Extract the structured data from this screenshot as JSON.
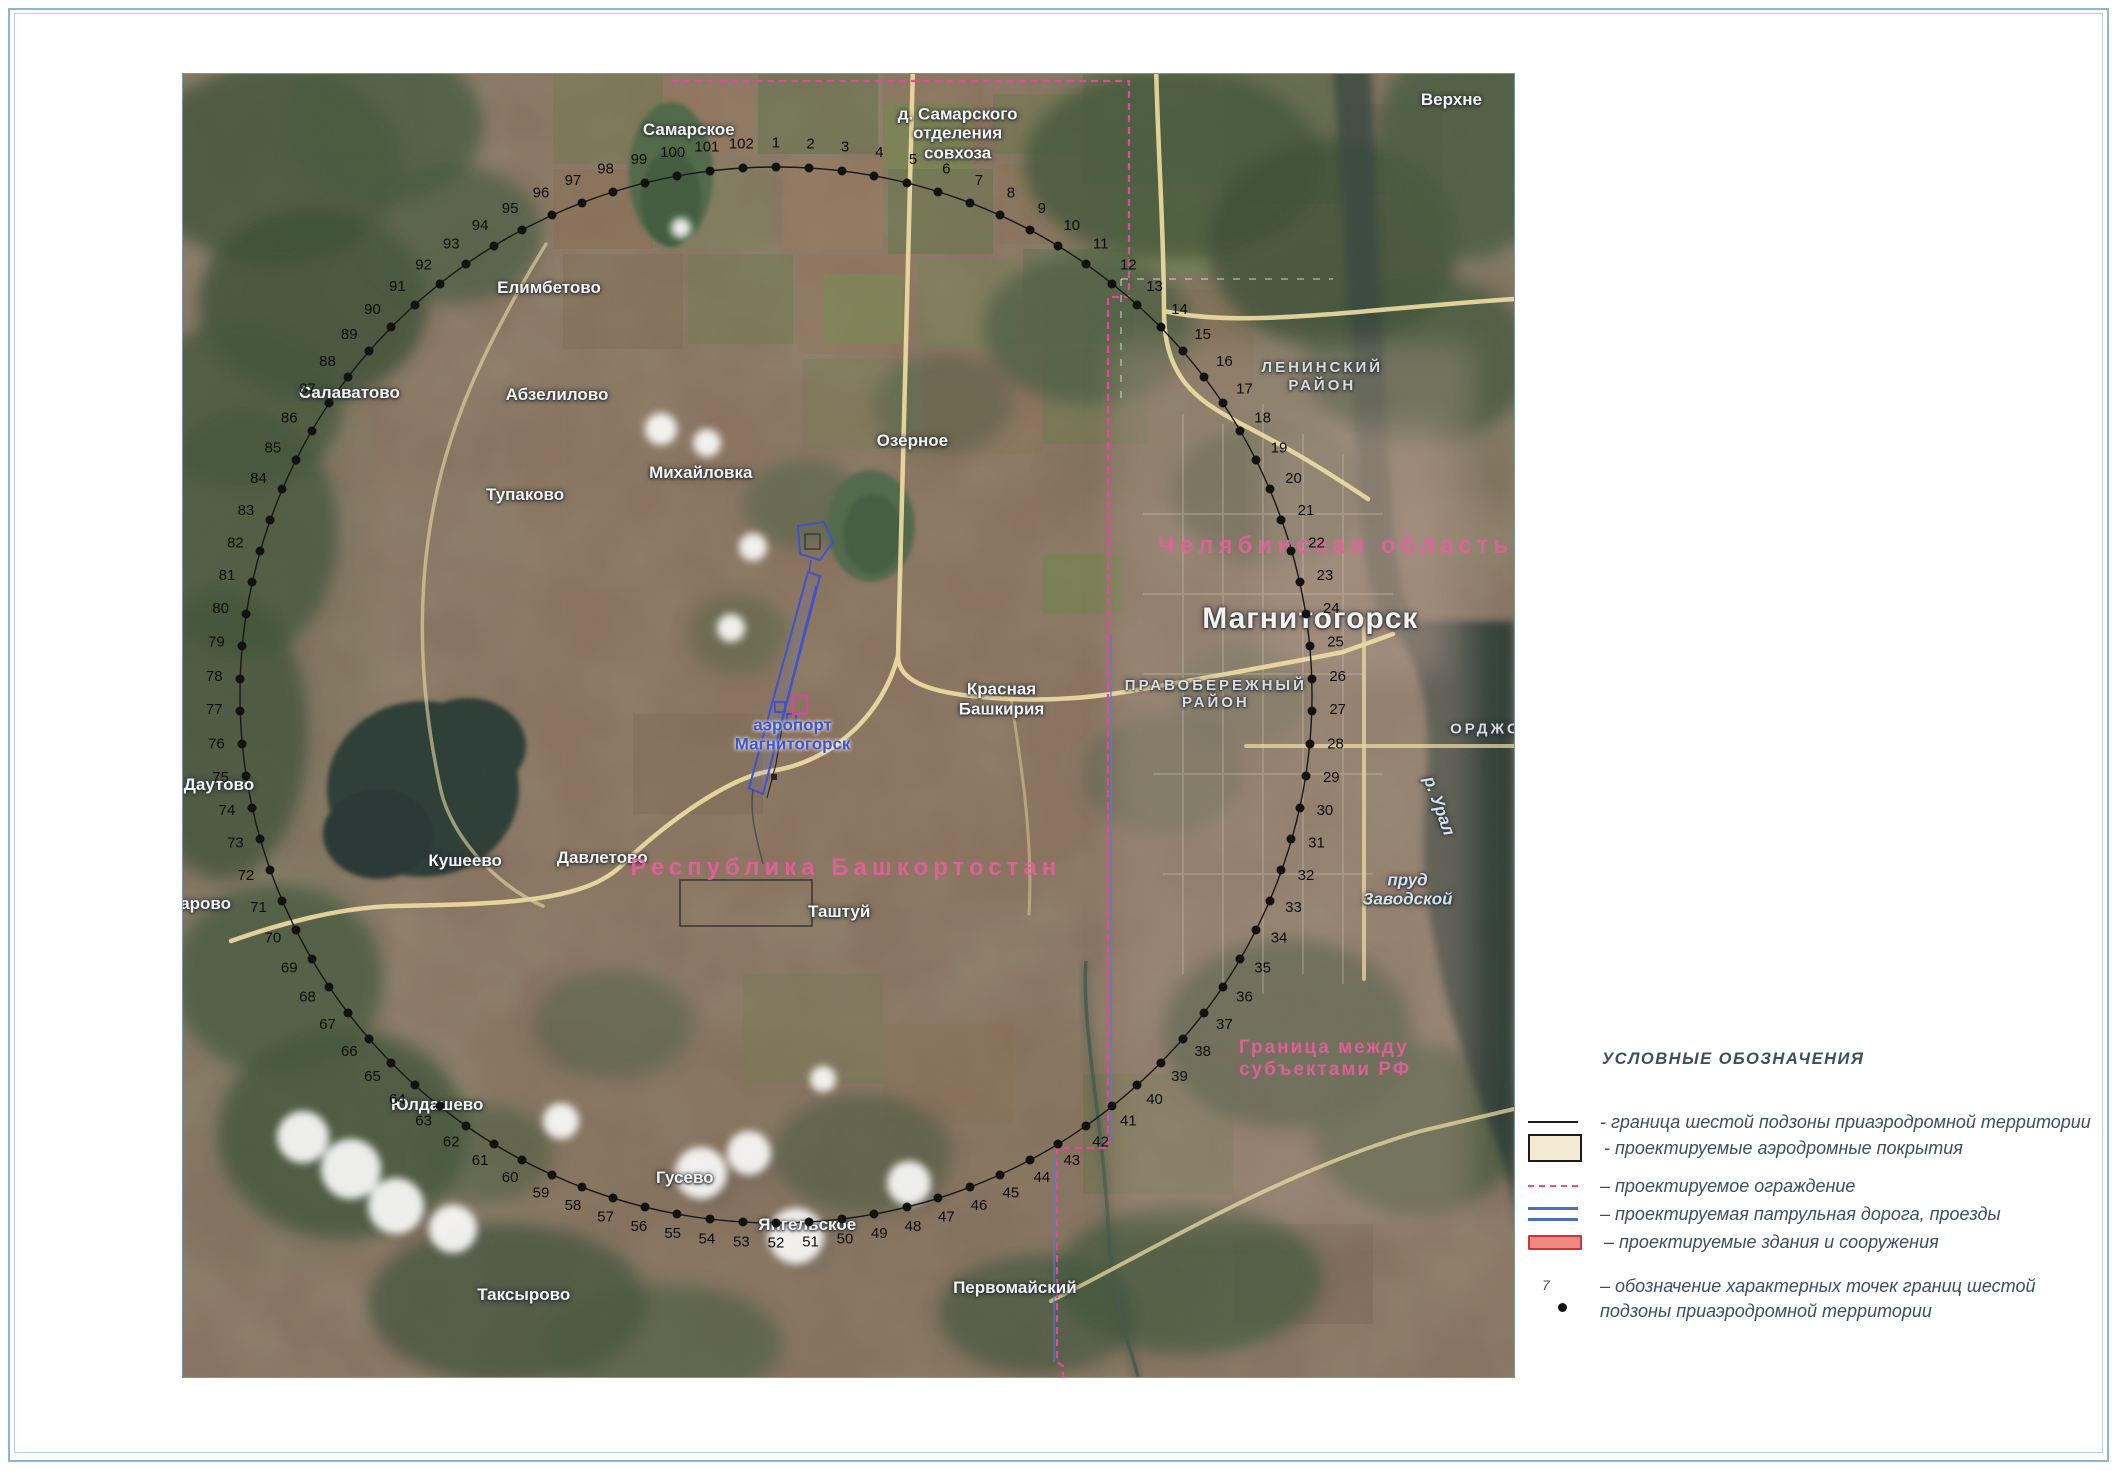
{
  "document": {
    "type": "boundary scheme map",
    "frame_color": "#8fb4d9"
  },
  "legend": {
    "title": "УСЛОВНЫЕ ОБОЗНАЧЕНИЯ",
    "items": [
      {
        "symbol": "solid-line",
        "label": "- граница шестой подзоны приаэродромной территории"
      },
      {
        "symbol": "paved-area",
        "label": "- проектируемые аэродромные покрытия"
      },
      {
        "symbol": "fence-dashed",
        "label": "–  проектируемое ограждение"
      },
      {
        "symbol": "patrol-road",
        "label": "–  проектируемая патрульная дорога, проезды"
      },
      {
        "symbol": "buildings",
        "label": "–  проектируемые здания и сооружения"
      },
      {
        "symbol": "char-point",
        "point_label": "7",
        "label": "–  обозначение характерных точек границ шестой\nподзоны приаэродромной территории"
      }
    ],
    "colors": {
      "text": "#3e4d60",
      "boundary_line": "#1c1c1c",
      "fence": "#e8509a",
      "patrol_road": "#4a6fc4",
      "paved_fill": "#f4ead2",
      "building_fill": "#ee8a80",
      "building_border": "#cf3333"
    }
  },
  "map": {
    "boundary_ring": {
      "count": 102,
      "first_number": 1,
      "last_number": 102,
      "direction": "clockwise",
      "start_angle_deg": -90,
      "cx": 44.55,
      "cy": 47.66,
      "rx": 40.27,
      "ry": 40.52,
      "dot_color": "#121212"
    },
    "places": [
      {
        "text": "Самарское",
        "x": 38.0,
        "y": 4.3,
        "cls": ""
      },
      {
        "text": "д. Самарского\nотделения\nсовхоза",
        "x": 58.2,
        "y": 4.6,
        "cls": ""
      },
      {
        "text": "Елимбетово",
        "x": 27.5,
        "y": 16.4,
        "cls": ""
      },
      {
        "text": "Абзелилово",
        "x": 28.1,
        "y": 24.6,
        "cls": ""
      },
      {
        "text": "Салаватово",
        "x": 12.5,
        "y": 24.5,
        "cls": ""
      },
      {
        "text": "Михайловка",
        "x": 38.9,
        "y": 30.6,
        "cls": ""
      },
      {
        "text": "Тупаково",
        "x": 25.7,
        "y": 32.3,
        "cls": ""
      },
      {
        "text": "Озерное",
        "x": 54.8,
        "y": 28.2,
        "cls": ""
      },
      {
        "text": "Красная\nБашкирия",
        "x": 61.5,
        "y": 48.0,
        "cls": ""
      },
      {
        "text": "аэропорт\nМагнитогорск",
        "x": 45.8,
        "y": 50.7,
        "cls": "blue"
      },
      {
        "text": "Даутово",
        "x": 2.7,
        "y": 54.6,
        "cls": ""
      },
      {
        "text": "арово",
        "x": 1.7,
        "y": 63.7,
        "cls": ""
      },
      {
        "text": "Кушеево",
        "x": 21.2,
        "y": 60.4,
        "cls": ""
      },
      {
        "text": "Давлетово",
        "x": 31.5,
        "y": 60.2,
        "cls": ""
      },
      {
        "text": "Таштуй",
        "x": 49.3,
        "y": 64.3,
        "cls": ""
      },
      {
        "text": "Юлдашево",
        "x": 19.1,
        "y": 79.1,
        "cls": ""
      },
      {
        "text": "Гусево",
        "x": 37.7,
        "y": 84.7,
        "cls": ""
      },
      {
        "text": "Таксырово",
        "x": 25.6,
        "y": 93.7,
        "cls": ""
      },
      {
        "text": "Янгельское",
        "x": 46.9,
        "y": 88.3,
        "cls": ""
      },
      {
        "text": "Первомайский",
        "x": 62.5,
        "y": 93.2,
        "cls": ""
      },
      {
        "text": "Верхне",
        "x": 95.3,
        "y": 2.0,
        "cls": ""
      },
      {
        "text": "Магнитогорск",
        "x": 84.7,
        "y": 41.8,
        "cls": "big"
      },
      {
        "text": "ЛЕНИНСКИЙ РАЙОН",
        "x": 85.6,
        "y": 23.2,
        "cls": "district"
      },
      {
        "text": "ПРАВОБЕРЕЖНЫЙ\nРАЙОН",
        "x": 77.6,
        "y": 47.6,
        "cls": "district"
      },
      {
        "text": "ОРДЖОН",
        "x": 98.4,
        "y": 50.3,
        "cls": "district"
      },
      {
        "text": "р. Урал",
        "x": 94.4,
        "y": 56.2,
        "cls": "water",
        "rot": 70
      },
      {
        "text": "пруд\nЗаводской",
        "x": 92.0,
        "y": 62.6,
        "cls": "water"
      },
      {
        "text": "Челябинская область",
        "x": 86.6,
        "y": 36.2,
        "cls": "pink"
      },
      {
        "text": "Республика Башкортостан",
        "x": 49.8,
        "y": 60.9,
        "cls": "pink"
      },
      {
        "text": "Граница между\nсубъектами РФ",
        "x": 85.8,
        "y": 75.6,
        "cls": "pink2"
      }
    ],
    "feature_colors": {
      "roads": "#f4e1a6",
      "water": "#2e3d37",
      "forest": "#41553a",
      "subject_boundary_dashed": "#ef3fa0",
      "airport_outline": "#3b4fd0",
      "ring_line": "#181818"
    }
  }
}
